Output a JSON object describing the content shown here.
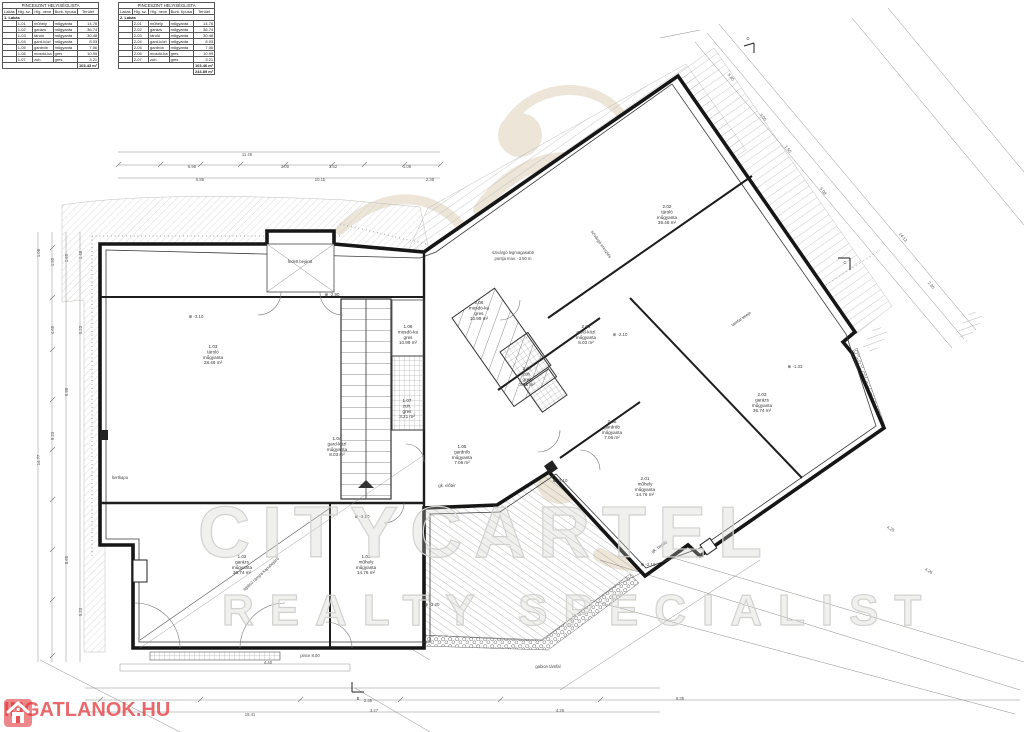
{
  "doc": {
    "type": "basement floor plan",
    "bg_color": "#ffffff",
    "ink_color": "#1a1a1a",
    "accent_red": "#e43e42",
    "watermark_tan": "#ddd1ba",
    "watermark_gray": "#d2d2cd"
  },
  "tables": {
    "title": "PINCESZINT HELYISÉGLISTA",
    "columns": [
      "Lakás",
      "Hlg. sz.",
      "Hlg. neve",
      "Burk. típusa",
      "Terület"
    ],
    "table1": {
      "group": "1. Lakás",
      "rows": [
        [
          "1-01",
          "műhely",
          "műgyanta",
          "14.76"
        ],
        [
          "1-02",
          "garázs",
          "műgyanta",
          "36.74"
        ],
        [
          "1-03",
          "tároló",
          "műgyanta",
          "30.48"
        ],
        [
          "1-04",
          "gard-közl",
          "műgyanta",
          "8.03"
        ],
        [
          "1-05",
          "gardrób",
          "műgyanta",
          "7.06"
        ],
        [
          "1-06",
          "mosdó-ka",
          "gres",
          "10.99"
        ],
        [
          "1-07",
          "zuh.",
          "gres",
          "3.21"
        ]
      ],
      "total": "103.43 m²"
    },
    "table2": {
      "group": "2. Lakás",
      "rows": [
        [
          "2-01",
          "műhely",
          "műgyanta",
          "14.76"
        ],
        [
          "2-02",
          "garázs",
          "műgyanta",
          "36.74"
        ],
        [
          "2-03",
          "tároló",
          "műgyanta",
          "30.48"
        ],
        [
          "2-04",
          "gard-közl",
          "műgyanta",
          "8.03"
        ],
        [
          "2-05",
          "gardrób",
          "műgyanta",
          "7.06"
        ],
        [
          "2-06",
          "mosdó-ka",
          "gres",
          "10.99"
        ],
        [
          "2-07",
          "zuh.",
          "gres",
          "3.21"
        ]
      ],
      "total": "103.46 m²",
      "grand_total": "244.89 m²"
    }
  },
  "rooms": [
    {
      "id": "1.03",
      "name": "tároló",
      "finish": "műgyanta",
      "area": "28.46 m²",
      "x": 213,
      "y": 348,
      "r": 0
    },
    {
      "id": "1.06",
      "name": "mosdó-ka",
      "finish": "gres",
      "area": "10.99 m²",
      "x": 408,
      "y": 328,
      "r": 0
    },
    {
      "id": "1.04",
      "name": "gard-közl",
      "finish": "műgyanta",
      "area": "8.03 m²",
      "x": 337,
      "y": 440,
      "r": 0
    },
    {
      "id": "1.07",
      "name": "zuh.",
      "finish": "gres",
      "area": "3.21 m²",
      "x": 407,
      "y": 402,
      "r": 0
    },
    {
      "id": "1.05",
      "name": "gardrób",
      "finish": "műgyanta",
      "area": "7.06 m²",
      "x": 462,
      "y": 448,
      "r": 0
    },
    {
      "id": "1.02",
      "name": "garázs",
      "finish": "műgyanta",
      "area": "36.74 m²",
      "x": 242,
      "y": 558,
      "r": 0
    },
    {
      "id": "1.01",
      "name": "műhely",
      "finish": "műgyanta",
      "area": "14.76 m²",
      "x": 366,
      "y": 558,
      "r": 0
    },
    {
      "id": "2.02",
      "name": "tároló",
      "finish": "műgyanta",
      "area": "35.46 m²",
      "x": 667,
      "y": 208,
      "r": 0
    },
    {
      "id": "2.06",
      "name": "mosdó-ka",
      "finish": "gres",
      "area": "10.99 m²",
      "x": 479,
      "y": 304,
      "r": 0
    },
    {
      "id": "2.04",
      "name": "gard-közl",
      "finish": "műgyanta",
      "area": "8.03 m²",
      "x": 586,
      "y": 328,
      "r": 0
    },
    {
      "id": "2.07",
      "name": "zuh.",
      "finish": "gres",
      "area": "3.21 m²",
      "x": 527,
      "y": 370,
      "r": 0
    },
    {
      "id": "2.05",
      "name": "gardrób",
      "finish": "műgyanta",
      "area": "7.06 m²",
      "x": 612,
      "y": 423,
      "r": 0
    },
    {
      "id": "2.01",
      "name": "műhely",
      "finish": "műgyanta",
      "area": "14.76 m²",
      "x": 645,
      "y": 480,
      "r": 0
    },
    {
      "id": "2.03",
      "name": "garázs",
      "finish": "műgyanta",
      "area": "36.74 m²",
      "x": 762,
      "y": 396,
      "r": 0
    }
  ],
  "annotations": [
    {
      "text": "szivárgó legmagasabb",
      "x": 513,
      "y": 254,
      "r": 0
    },
    {
      "text": "pontja max. -3.50 m",
      "x": 513,
      "y": 260,
      "r": 0
    },
    {
      "text": "kertkapu",
      "x": 120,
      "y": 479,
      "r": 0
    },
    {
      "text": "gk. előtér",
      "x": 447,
      "y": 487,
      "r": 0
    },
    {
      "text": "gk. beálló",
      "x": 660,
      "y": 548,
      "r": -35
    },
    {
      "text": "gabion támfal",
      "x": 548,
      "y": 668,
      "r": 0
    },
    {
      "text": "fedett bejárat",
      "x": 300,
      "y": 263,
      "r": 0
    },
    {
      "text": "lejtésű rámpa kapubejáró",
      "x": 262,
      "y": 575,
      "r": -43
    },
    {
      "text": "szivárgó eresztés",
      "x": 600,
      "y": 245,
      "r": 55
    },
    {
      "text": "támfal teteje",
      "x": 742,
      "y": 320,
      "r": -35
    },
    {
      "text": "pince 8.00",
      "x": 310,
      "y": 657,
      "r": 0
    },
    {
      "text": "D",
      "x": 748,
      "y": 40,
      "r": 0
    },
    {
      "text": "C",
      "x": 845,
      "y": 264,
      "r": 0
    },
    {
      "text": "B",
      "x": 358,
      "y": 700,
      "r": 0
    }
  ],
  "levels": [
    {
      "v": "-2.90",
      "x": 332,
      "y": 296
    },
    {
      "v": "-3.10",
      "x": 196,
      "y": 318
    },
    {
      "v": "-3.10",
      "x": 362,
      "y": 518
    },
    {
      "v": "-2.10",
      "x": 560,
      "y": 482
    },
    {
      "v": "-2.10",
      "x": 648,
      "y": 566
    },
    {
      "v": "-1.33",
      "x": 795,
      "y": 368
    },
    {
      "v": "-3.20",
      "x": 432,
      "y": 606
    },
    {
      "v": "-2.10",
      "x": 620,
      "y": 336
    }
  ],
  "dims": [
    {
      "v": "11.46",
      "x": 247,
      "y": 156,
      "r": 0
    },
    {
      "v": "6.98",
      "x": 192,
      "y": 168,
      "r": 0
    },
    {
      "v": "3.00",
      "x": 285,
      "y": 168,
      "r": 0
    },
    {
      "v": "3.52",
      "x": 333,
      "y": 168,
      "r": 0
    },
    {
      "v": "1.08",
      "x": 407,
      "y": 168,
      "r": 0
    },
    {
      "v": "5.85",
      "x": 200,
      "y": 181,
      "r": 0
    },
    {
      "v": "10.15",
      "x": 320,
      "y": 181,
      "r": 0
    },
    {
      "v": "2.38",
      "x": 430,
      "y": 181,
      "r": 0
    },
    {
      "v": "1.08",
      "x": 40,
      "y": 253,
      "r": -90
    },
    {
      "v": "1.50",
      "x": 54,
      "y": 262,
      "r": -90
    },
    {
      "v": "1.65",
      "x": 68,
      "y": 258,
      "r": -90
    },
    {
      "v": "1.48",
      "x": 82,
      "y": 255,
      "r": -90
    },
    {
      "v": "14.77",
      "x": 40,
      "y": 460,
      "r": -90
    },
    {
      "v": "4.65",
      "x": 54,
      "y": 330,
      "r": -90
    },
    {
      "v": "9.23",
      "x": 54,
      "y": 436,
      "r": -90
    },
    {
      "v": "6.98",
      "x": 68,
      "y": 392,
      "r": -90
    },
    {
      "v": "5.23",
      "x": 82,
      "y": 330,
      "r": -90
    },
    {
      "v": "8.65",
      "x": 68,
      "y": 560,
      "r": -90
    },
    {
      "v": "5.23",
      "x": 82,
      "y": 612,
      "r": -90
    },
    {
      "v": "5.45",
      "x": 730,
      "y": 78,
      "r": 50
    },
    {
      "v": "3.00",
      "x": 762,
      "y": 118,
      "r": 50
    },
    {
      "v": "1.50",
      "x": 787,
      "y": 150,
      "r": 50
    },
    {
      "v": "5.08",
      "x": 822,
      "y": 192,
      "r": 50
    },
    {
      "v": "14.13",
      "x": 902,
      "y": 238,
      "r": 50
    },
    {
      "v": "2.30",
      "x": 930,
      "y": 286,
      "r": 50
    },
    {
      "v": "4.40",
      "x": 268,
      "y": 664,
      "r": 0
    },
    {
      "v": "19.41",
      "x": 250,
      "y": 716,
      "r": 0
    },
    {
      "v": "2.35",
      "x": 368,
      "y": 702,
      "r": 0
    },
    {
      "v": "3.27",
      "x": 374,
      "y": 712,
      "r": 0
    },
    {
      "v": "4.26",
      "x": 560,
      "y": 712,
      "r": 0
    },
    {
      "v": "4.25",
      "x": 890,
      "y": 530,
      "r": 30
    },
    {
      "v": "4.26",
      "x": 928,
      "y": 572,
      "r": 30
    },
    {
      "v": "6.35",
      "x": 680,
      "y": 700,
      "r": 0
    }
  ],
  "watermarks": {
    "brand_line1": "CITYCARTEL",
    "brand_line2": "REALTY SPECIALIST",
    "portal_logo_text": "INGATLANOK.HU"
  }
}
